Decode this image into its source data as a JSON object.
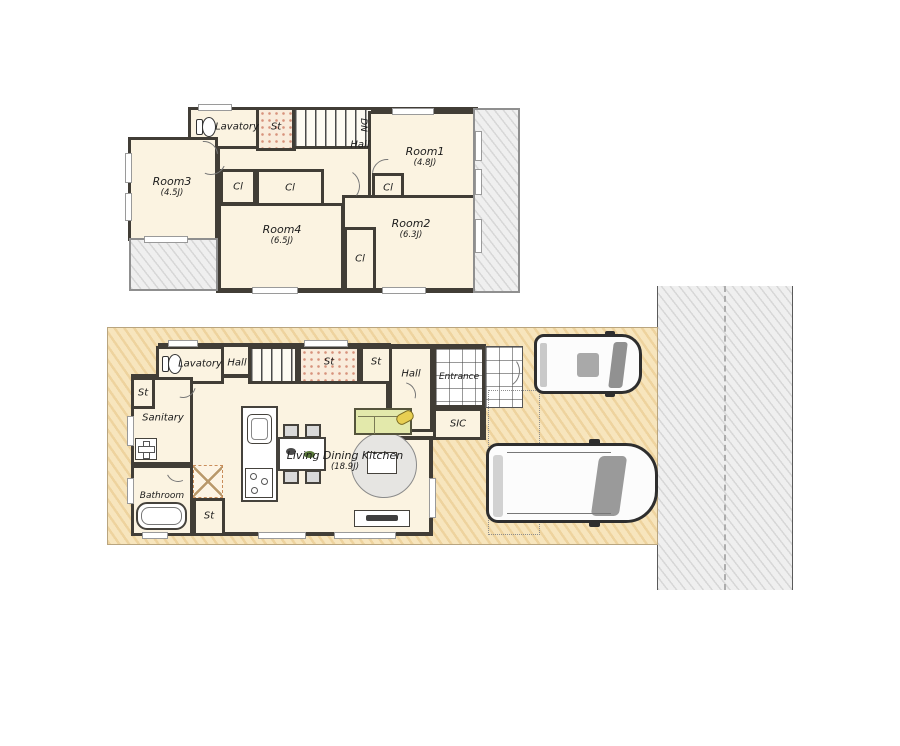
{
  "floor2": {
    "lavatory": "Lavatory",
    "st": "St",
    "dn": "DN",
    "hall": "Hall",
    "closet": "Cl",
    "room1": {
      "name": "Room1",
      "area": "(4.8J)"
    },
    "room2": {
      "name": "Room2",
      "area": "(6.3J)"
    },
    "room3": {
      "name": "Room3",
      "area": "(4.5J)"
    },
    "room4": {
      "name": "Room4",
      "area": "(6.5J)"
    }
  },
  "floor1": {
    "lavatory": "Lavatory",
    "hall_upper": "Hall",
    "storage": "St",
    "hall": "Hall",
    "entrance": "Entrance",
    "sanitary": "Sanitary",
    "sic": "SIC",
    "bathroom": "Bathroom",
    "ldk": {
      "name": "Living Dining Kitchen",
      "area": "(18.9J)"
    }
  }
}
